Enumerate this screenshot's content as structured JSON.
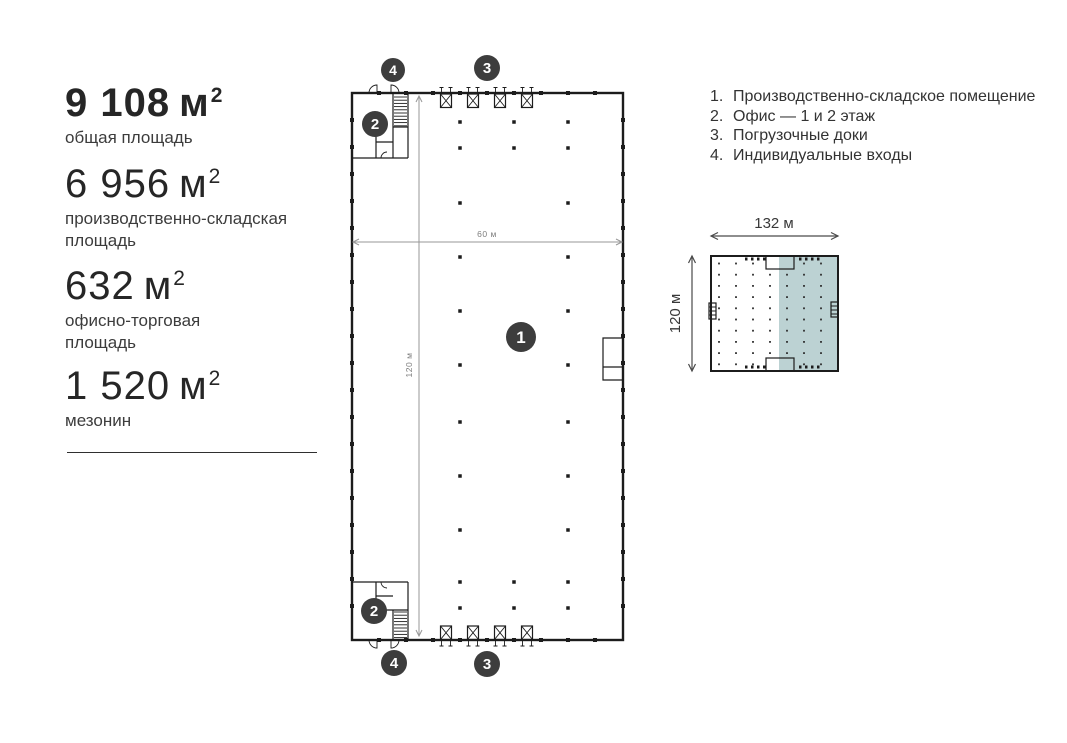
{
  "stats": {
    "items": [
      {
        "value": "9 108",
        "unit": "м",
        "sup": "2",
        "label": "общая площадь"
      },
      {
        "value": "6 956",
        "unit": "м",
        "sup": "2",
        "label": "производственно-складская площадь"
      },
      {
        "value": "632",
        "unit": "м",
        "sup": "2",
        "label": "офисно-торговая площадь"
      },
      {
        "value": "1 520",
        "unit": "м",
        "sup": "2",
        "label": "мезонин"
      }
    ]
  },
  "legend": {
    "items": [
      {
        "num": "1.",
        "label": "Производственно-складское помещение"
      },
      {
        "num": "2.",
        "label": "Офис — 1 и 2 этаж"
      },
      {
        "num": "3.",
        "label": "Погрузочные доки"
      },
      {
        "num": "4.",
        "label": "Индивидуальные входы"
      }
    ]
  },
  "floorplan": {
    "badges": [
      "4",
      "3",
      "2",
      "1",
      "2",
      "4",
      "3"
    ],
    "width_label": "60 м",
    "height_label": "120 м"
  },
  "minimap": {
    "width_label": "132 м",
    "height_label": "120 м",
    "highlight_color": "#bcd2d3"
  },
  "colors": {
    "badge": "#3d3d3d",
    "plan_line": "#1c1c1c",
    "dimension_line": "#979797",
    "text": "#2e2e2e"
  }
}
